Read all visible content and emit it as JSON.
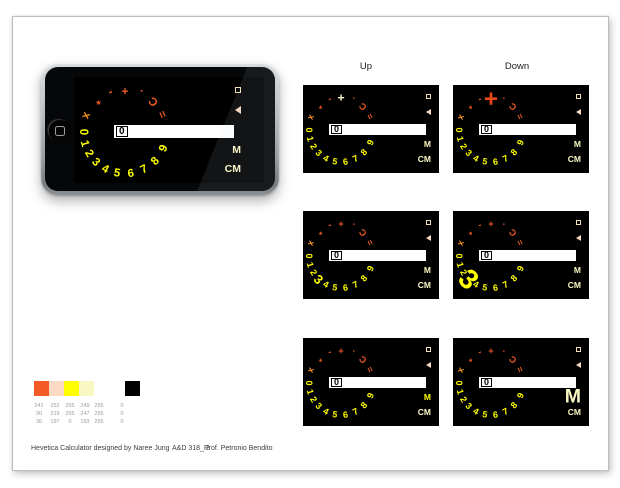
{
  "sheet": {
    "caption": {
      "title": "Hevetica Calculator designed by Naree Jung",
      "course": "A&D 318_ 2",
      "professor": "Prof. Petronio Bendito"
    },
    "column_labels": {
      "up": "Up",
      "down": "Down"
    }
  },
  "palette": {
    "swatches": [
      {
        "name": "orange",
        "hex": "#F15A24"
      },
      {
        "name": "peach",
        "hex": "#FCDBC5"
      },
      {
        "name": "yellow",
        "hex": "#FFFF00"
      },
      {
        "name": "cream",
        "hex": "#F9F7C1"
      },
      {
        "name": "white",
        "hex": "#FFFFFF"
      },
      {
        "name": "black",
        "hex": "#000000"
      }
    ],
    "rgb_rows": [
      [
        "241",
        "252",
        "255",
        "249",
        "255",
        "0"
      ],
      [
        "90",
        "219",
        "255",
        "247",
        "255",
        "0"
      ],
      [
        "36",
        "197",
        "0",
        "193",
        "255",
        "0"
      ]
    ]
  },
  "calculator": {
    "display_value": "0",
    "dial_keys": [
      {
        "ch": "x",
        "phi": 293,
        "color": "#F7941D"
      },
      {
        "ch": "*",
        "phi": 318,
        "color": "#F15A24"
      },
      {
        "ch": "-",
        "phi": 340,
        "color": "#F15A24"
      },
      {
        "ch": "+",
        "phi": 0,
        "color": "#F15A24"
      },
      {
        "ch": ".",
        "phi": 22,
        "color": "#F15A24"
      },
      {
        "ch": "C",
        "phi": 43,
        "color": "#F15A24"
      },
      {
        "ch": "=",
        "phi": 65,
        "color": "#F15A24"
      },
      {
        "ch": "9",
        "phi": 113,
        "color": "#FFFF00"
      },
      {
        "ch": "8",
        "phi": 134,
        "color": "#FFFF00"
      },
      {
        "ch": "7",
        "phi": 153,
        "color": "#FFFF00"
      },
      {
        "ch": "6",
        "phi": 172,
        "color": "#FFFF00"
      },
      {
        "ch": "5",
        "phi": 191,
        "color": "#FFFF00"
      },
      {
        "ch": "4",
        "phi": 208,
        "color": "#FFFF00"
      },
      {
        "ch": "3",
        "phi": 224,
        "color": "#FFFF00"
      },
      {
        "ch": "2",
        "phi": 239,
        "color": "#FFFF00"
      },
      {
        "ch": "1",
        "phi": 254,
        "color": "#FFFF00"
      },
      {
        "ch": "0",
        "phi": 270,
        "color": "#FFFF00"
      }
    ],
    "side_buttons": {
      "memory": "M",
      "clear_memory": "CM"
    }
  },
  "demo_screens": [
    {
      "id": "up-plus",
      "column": "up",
      "row": 1,
      "display_value": "0",
      "highlight": {
        "key": "+",
        "color": "#F9F7C1",
        "scale": 1.35
      }
    },
    {
      "id": "down-plus",
      "column": "down",
      "row": 1,
      "display_value": "0",
      "highlight": {
        "key": "+",
        "color": "#E8491B",
        "scale": 2.7
      }
    },
    {
      "id": "up-3",
      "column": "up",
      "row": 2,
      "display_value": "0",
      "highlight": {
        "key": "3",
        "color": "#FFFF00",
        "scale": 1.45
      }
    },
    {
      "id": "down-3",
      "column": "down",
      "row": 2,
      "display_value": "0",
      "highlight": {
        "key": "3",
        "color": "#FFFF00",
        "scale": 3.1
      }
    },
    {
      "id": "up-m",
      "column": "up",
      "row": 3,
      "display_value": "0",
      "highlight": {
        "key": "M",
        "color": "#FFFF00",
        "scale": 1.0
      }
    },
    {
      "id": "down-m",
      "column": "down",
      "row": 3,
      "display_value": "0",
      "highlight": {
        "key": "M",
        "color": "#F9F7C1",
        "scale": 2.3
      }
    }
  ]
}
